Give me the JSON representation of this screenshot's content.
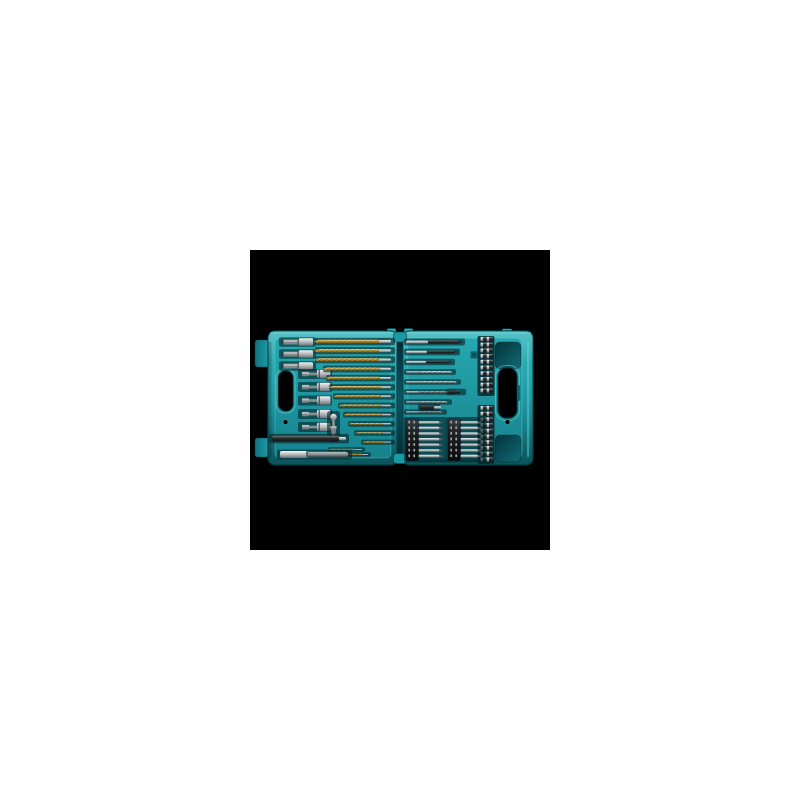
{
  "page": {
    "background": "#ffffff"
  },
  "scene": {
    "canvas": {
      "x": 250,
      "y": 250,
      "size": 300,
      "background": "#000000"
    },
    "colors": {
      "teal_top": "#38b6ba",
      "teal_mid": "#1d9ea7",
      "teal_deep": "#0f727d",
      "teal_edge": "#06454e",
      "teal_light": "#72d4d7",
      "panel_top": "#27a8b0",
      "panel_bottom": "#15828d",
      "recess_dark": "#04333b",
      "recess_mid": "#0f6b76",
      "hinge_dark": "#02242a",
      "hinge_mid": "#0d5660",
      "well": "#04262c",
      "gold_hi": "#f2d57d",
      "gold_mid": "#c2922a",
      "gold_dark": "#7c5c12",
      "silver_hi": "#f0f2f2",
      "silver_mid": "#b4b9bc",
      "silver_dark": "#6a7074",
      "steel_hi": "#c6cacc",
      "steel_mid": "#84898c",
      "steel_dark": "#4f5457",
      "black_hi": "#53585a",
      "black_mid": "#26292b",
      "black_deep": "#101214",
      "holder_top": "#3a3e40",
      "holder_black": "#1b1d1f",
      "holder_deep": "#0a0c0e",
      "dot_grey": "#9aa0a2",
      "hole_black": "#000000"
    },
    "contents": {
      "titanium_drill_bits": 14,
      "black_hss_drill_bits": 3,
      "steel_drill_bits": 5,
      "insert_bits": 20,
      "power_screwdriver_bits": 14,
      "nut_setters": 5,
      "socket_adapters": 3,
      "countersink_bits": 1,
      "bit_holder_bars": 1,
      "magnetic_bit_holders": 1
    },
    "gold_drills": {
      "shank_end": 141,
      "rows": [
        [
          91.5,
          68,
          3.6,
          13
        ],
        [
          100.7,
          68,
          3.4,
          13
        ],
        [
          109.8,
          68,
          3.2,
          13
        ],
        [
          119.0,
          76,
          2.9,
          12
        ],
        [
          128.1,
          79,
          2.7,
          12
        ],
        [
          137.3,
          82,
          2.5,
          11
        ],
        [
          146.4,
          86,
          2.3,
          11
        ],
        [
          155.6,
          91,
          2.1,
          10
        ],
        [
          164.7,
          96,
          1.9,
          10
        ],
        [
          173.9,
          101,
          1.8,
          9
        ],
        [
          183.0,
          107,
          1.6,
          9
        ],
        [
          192.2,
          114,
          1.4,
          8
        ]
      ],
      "loose": [
        [
          199.5,
          80,
          32,
          1.3
        ],
        [
          204.5,
          86,
          32,
          1.2
        ]
      ]
    },
    "right_drills": {
      "shank_start": 156,
      "rows": [
        [
          "black",
          92,
          209,
          3.2,
          22
        ],
        [
          "black",
          102,
          204,
          3.0,
          21
        ],
        [
          "black",
          112,
          199,
          2.8,
          20
        ],
        [
          "bright",
          122,
          200,
          1.9,
          14
        ],
        [
          "bright",
          132,
          205,
          1.8,
          14
        ],
        [
          "grey",
          142,
          200,
          1.8,
          13
        ],
        [
          "bright",
          152,
          196,
          1.6,
          13
        ],
        [
          "grey",
          162,
          191,
          1.5,
          12
        ]
      ],
      "extras": [
        [
          198,
          142,
          12,
          3.2
        ],
        [
          170,
          157.5,
          14,
          4.0
        ]
      ]
    },
    "insert_columns": {
      "x": 230.5,
      "w": 12.5,
      "h": 4.2,
      "groups": [
        {
          "y0": 89,
          "dy": 5.72,
          "n": 10
        },
        {
          "y0": 158,
          "dy": 5.72,
          "n": 10
        }
      ]
    },
    "screw_strips": {
      "y0": 172.5,
      "dy": 5.6,
      "n": 7,
      "holder_y": 169,
      "holder_h": 41.5,
      "holder_w": 12.5,
      "strips": [
        {
          "holder_x": 156,
          "bit_x": 168.5,
          "bit_len": 24
        },
        {
          "holder_x": 198,
          "bit_x": 210.5,
          "bit_len": 20.5
        }
      ]
    },
    "nut_setters": {
      "ys": [
        124,
        137,
        150.5,
        164,
        177
      ]
    },
    "hex_adapters": {
      "ys": [
        92,
        104,
        116
      ]
    },
    "countersink": {
      "cx": 83.5,
      "top": 163
    },
    "holder_bar": {
      "y": 188.6
    },
    "magnetic_holder": {
      "y": 204.5
    }
  }
}
